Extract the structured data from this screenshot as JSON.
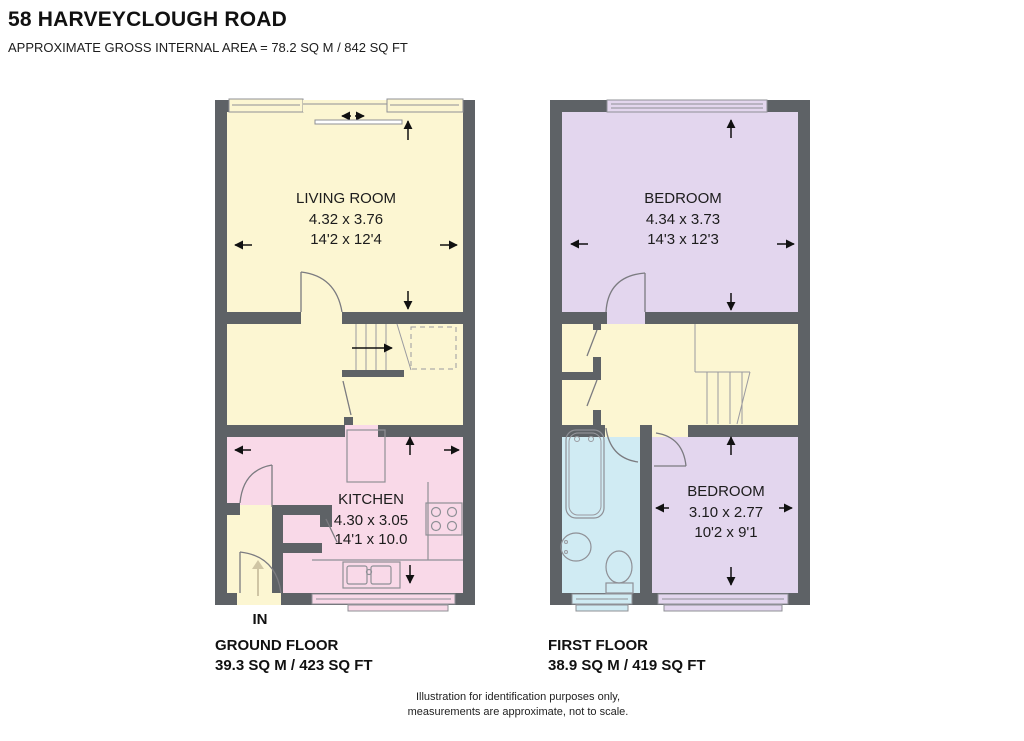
{
  "header": {
    "title": "58 HARVEYCLOUGH ROAD",
    "subtitle": "APPROXIMATE GROSS INTERNAL AREA = 78.2 SQ M / 842 SQ FT"
  },
  "ground_floor": {
    "name": "GROUND FLOOR",
    "area": "39.3  SQ M / 423 SQ FT",
    "entrance_label": "IN",
    "rooms": [
      {
        "name": "LIVING ROOM",
        "metric": "4.32 x 3.76",
        "imperial": "14'2 x 12'4"
      },
      {
        "name": "KITCHEN",
        "metric": "4.30 x 3.05",
        "imperial": "14'1 x 10.0"
      }
    ]
  },
  "first_floor": {
    "name": "FIRST FLOOR",
    "area": "38.9 SQ M / 419 SQ FT",
    "rooms": [
      {
        "name": "BEDROOM",
        "metric": "4.34 x 3.73",
        "imperial": "14'3 x 12'3"
      },
      {
        "name": "BEDROOM",
        "metric": "3.10 x 2.77",
        "imperial": "10'2 x 9'1"
      }
    ]
  },
  "footer": {
    "line1": "Illustration for identification purposes only,",
    "line2": "measurements are approximate, not to scale."
  },
  "colors": {
    "wall": "#5e6266",
    "hall_cream": "#fcf6d2",
    "kitchen_pink": "#f9d9e8",
    "bedroom_lavender": "#e3d6ee",
    "bathroom_blue": "#d0ebf3"
  }
}
